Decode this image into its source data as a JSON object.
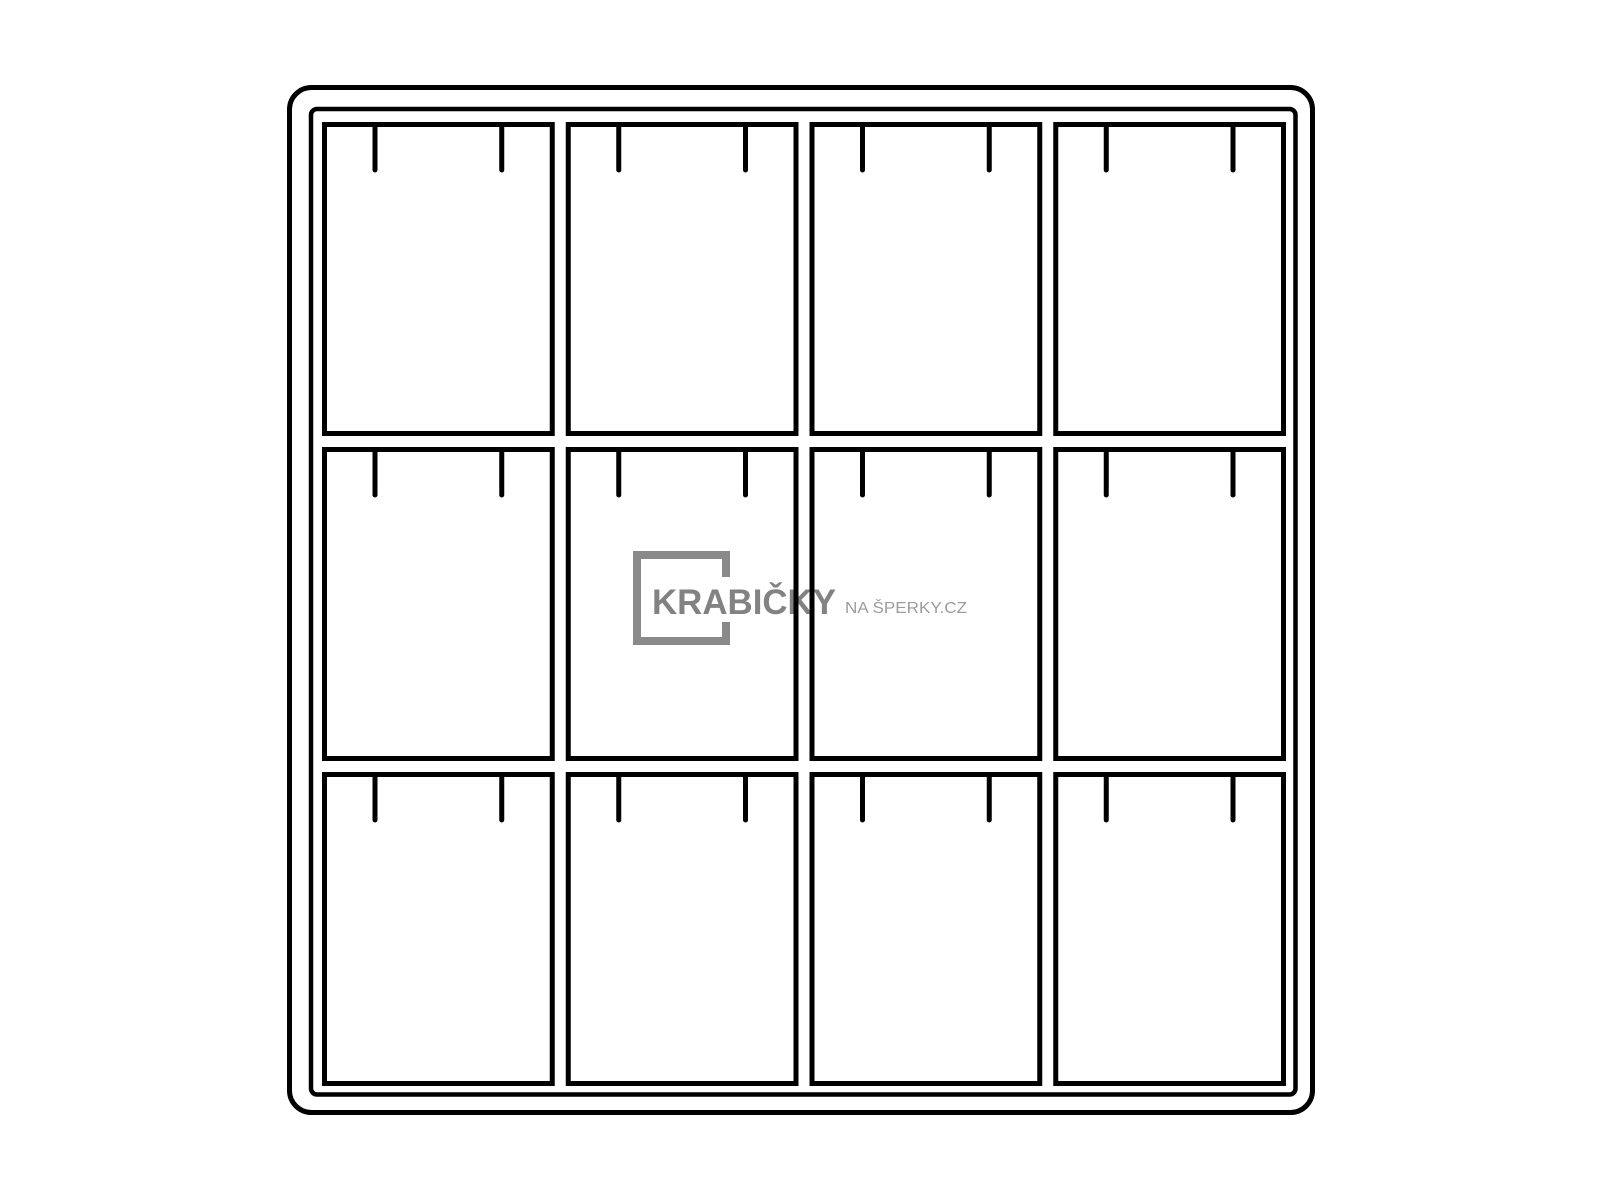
{
  "page": {
    "background": "#ffffff",
    "description": "Line drawing of a jewelry tray insert with 12 compartments, each with two hanging hook pins"
  },
  "watermark": {
    "brand": "KRABIČKY",
    "suffix": "NA ŠPERKY.CZ",
    "brand_color": "#828282",
    "suffix_color": "#9c9c9c",
    "square_color": "#8a8a8a",
    "gap_color": "#ffffff"
  },
  "drawing": {
    "line_color": "#000000",
    "fill": "none",
    "compartments": {
      "rows": 3,
      "columns": 4,
      "count": 12,
      "pins_per_compartment": 2
    },
    "outer_frame": {
      "x": 287,
      "y": 85,
      "width": 1028,
      "height": 1030,
      "radius": 22,
      "stroke": 5
    },
    "inner_frame": {
      "x": 309,
      "y": 107,
      "width": 989,
      "height": 990,
      "radius": 6,
      "stroke": 4.5
    },
    "grid": {
      "x": 322,
      "y": 122,
      "width": 964,
      "height": 964,
      "gap": 11,
      "cell_stroke": 5
    },
    "pins": {
      "edge_inset": 53,
      "length": 48,
      "width": 5
    }
  }
}
